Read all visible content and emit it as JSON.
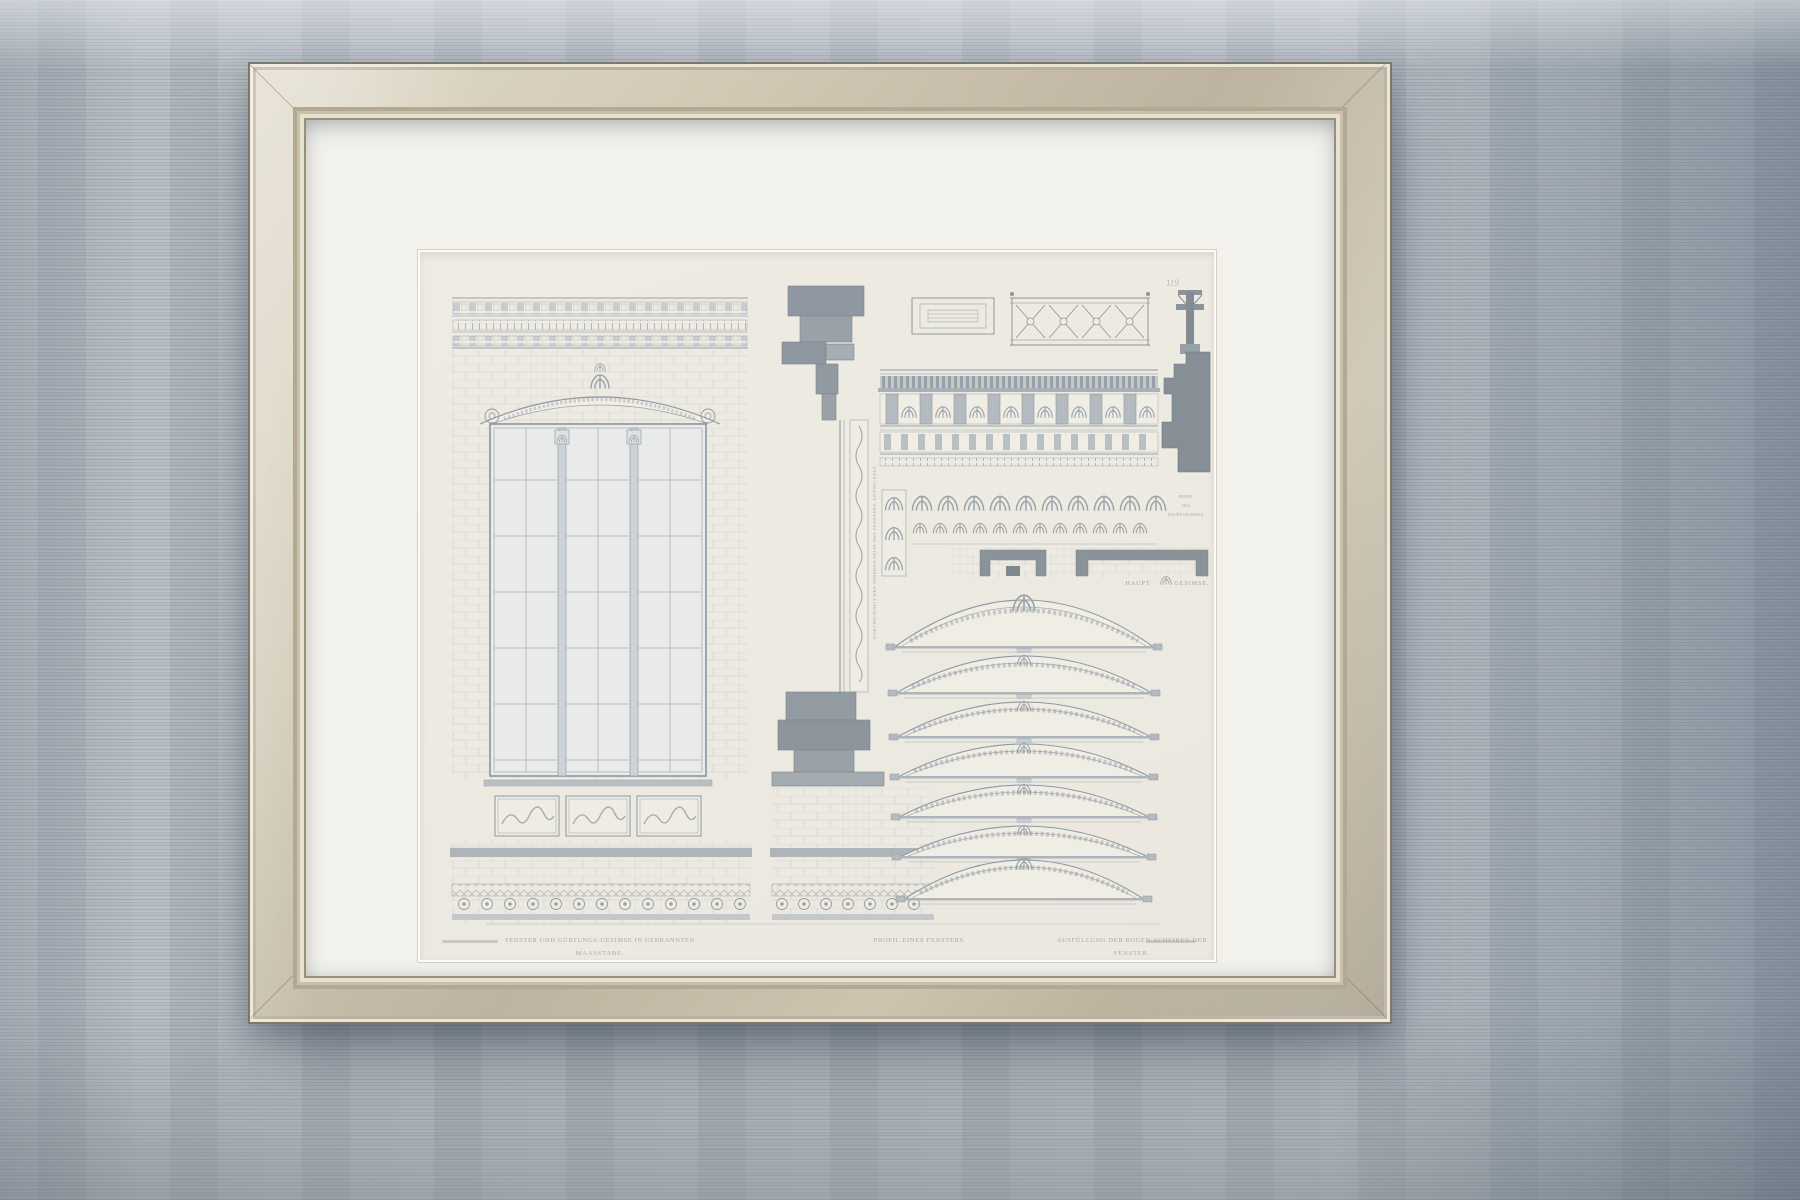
{
  "artwork": {
    "plate_number": "119",
    "captions": {
      "left_line1": "FENSTER UND GÜRTUNGS-GESIMSE IN GEBRANNTEN",
      "left_line2": "MAASSTABE.",
      "middle": "PROFIL EINES FENSTERS.",
      "right_line1": "AUSFÜLLUNG DER BOGEN-SCHEIBEN DER",
      "right_line2": "FENSTER.",
      "cornice_word_left": "HAUPT",
      "cornice_word_right": "GESIMSE.",
      "profile_label_l1": "PROFIL",
      "profile_label_l2": "DES",
      "profile_label_l3": "HAUPT-GESIMSES.",
      "section_note_vertical": "DURCHSCHNITT DER INNEREN SEITE DES FENSTERS, ENTWICKELT."
    },
    "colors": {
      "wall": "#aeb6be",
      "frame": "#c9bfab",
      "mat": "#f2f1ec",
      "paper": "#edeae2",
      "ink": "#97a0a7"
    }
  }
}
